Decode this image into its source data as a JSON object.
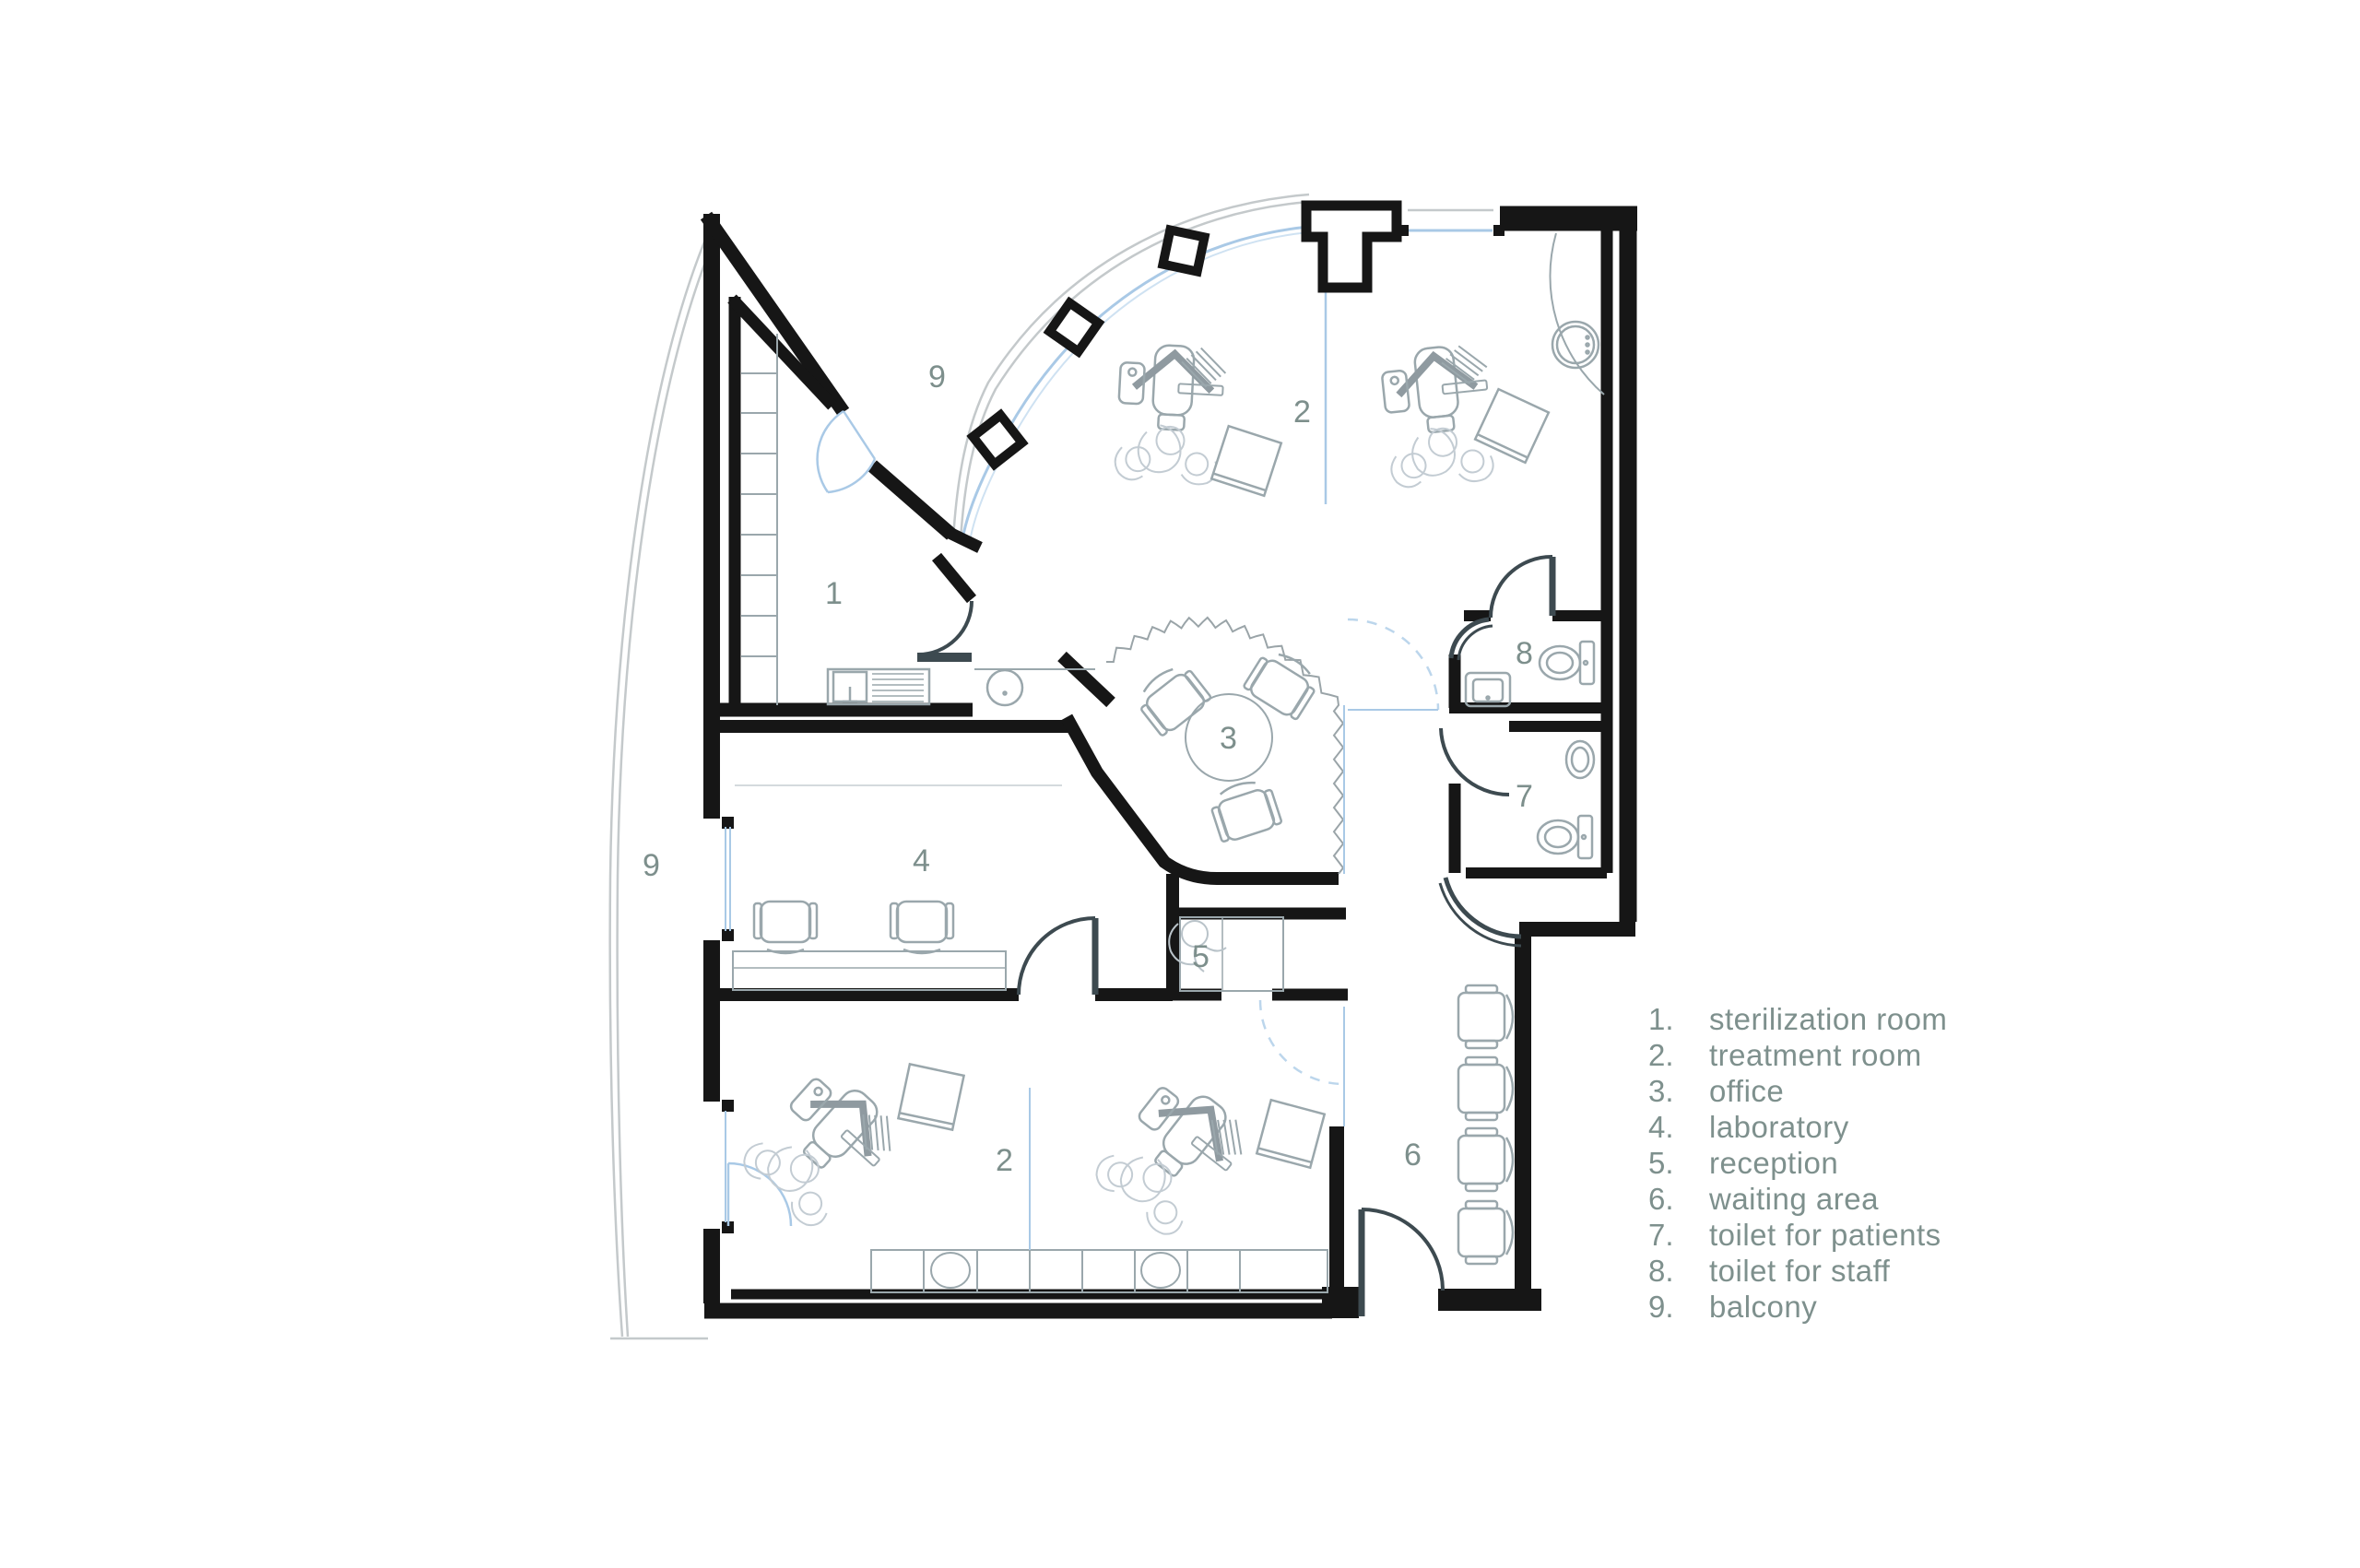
{
  "title": "dental clinic floor plan",
  "colors": {
    "wall": "#161616",
    "label_text": "#7d8f8c",
    "glass": "#a9c9e6",
    "dashed_door": "#bcd6ec",
    "dark_door": "#4b5a61",
    "furniture": "#9aa7ac",
    "balcony_rail": "#c4c9cb",
    "background": "#ffffff"
  },
  "legend": {
    "items": [
      {
        "num": "1.",
        "label": "sterilization room"
      },
      {
        "num": "2.",
        "label": "treatment room"
      },
      {
        "num": "3.",
        "label": "office"
      },
      {
        "num": "4.",
        "label": "laboratory"
      },
      {
        "num": "5.",
        "label": "reception"
      },
      {
        "num": "6.",
        "label": "waiting area"
      },
      {
        "num": "7.",
        "label": "toilet for patients"
      },
      {
        "num": "8.",
        "label": "toilet for staff"
      },
      {
        "num": "9.",
        "label": "balcony"
      }
    ]
  },
  "room_labels": {
    "sterilization": "1",
    "treatment_top": "2",
    "treatment_bottom": "2",
    "office": "3",
    "laboratory": "4",
    "reception": "5",
    "waiting": "6",
    "toilet_patients": "7",
    "toilet_staff": "8",
    "balcony_top": "9",
    "balcony_left": "9"
  }
}
